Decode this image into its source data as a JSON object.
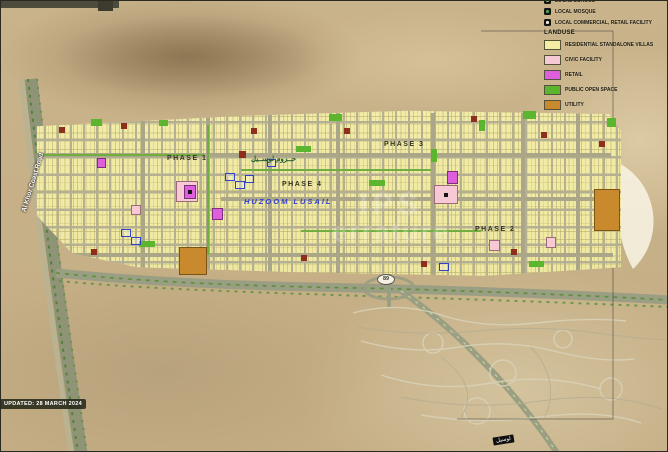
{
  "legend": {
    "pois": [
      {
        "label": "LOCAL SCHOOL",
        "glyph_color": "#7cc24a"
      },
      {
        "label": "LOCAL MOSQUE",
        "glyph_color": "#4aa34a"
      },
      {
        "label": "LOCAL COMMERCIAL, RETAIL FACILITY",
        "glyph_color": "#f0ead0"
      }
    ],
    "landuse_title": "LANDUSE",
    "items": [
      {
        "label": "RESIDENTIAL STANDALONE VILLAS",
        "color": "#f4eea4"
      },
      {
        "label": "CIVIC FACILITY",
        "color": "#f6c9d4"
      },
      {
        "label": "RETAIL",
        "color": "#dd5fdd"
      },
      {
        "label": "PUBLIC OPEN SPACE",
        "color": "#5cb52f"
      },
      {
        "label": "UTILITY",
        "color": "#c9892d"
      }
    ]
  },
  "map": {
    "phases": [
      {
        "label": "PHASE 1"
      },
      {
        "label": "PHASE 2"
      },
      {
        "label": "PHASE 3"
      },
      {
        "label": "PHASE 4"
      }
    ],
    "project_name": "HUZOOM LUSAIL",
    "project_name_ar": "حــزوم لوســيل",
    "coast_road": "Al Khor Coast Road",
    "route_number": "89",
    "road_tag_ar": "لوسيل",
    "updated": "UPDATED: 28 MARCH 2024"
  },
  "watermark": {
    "line1": "IPS",
    "line2": "errature"
  }
}
